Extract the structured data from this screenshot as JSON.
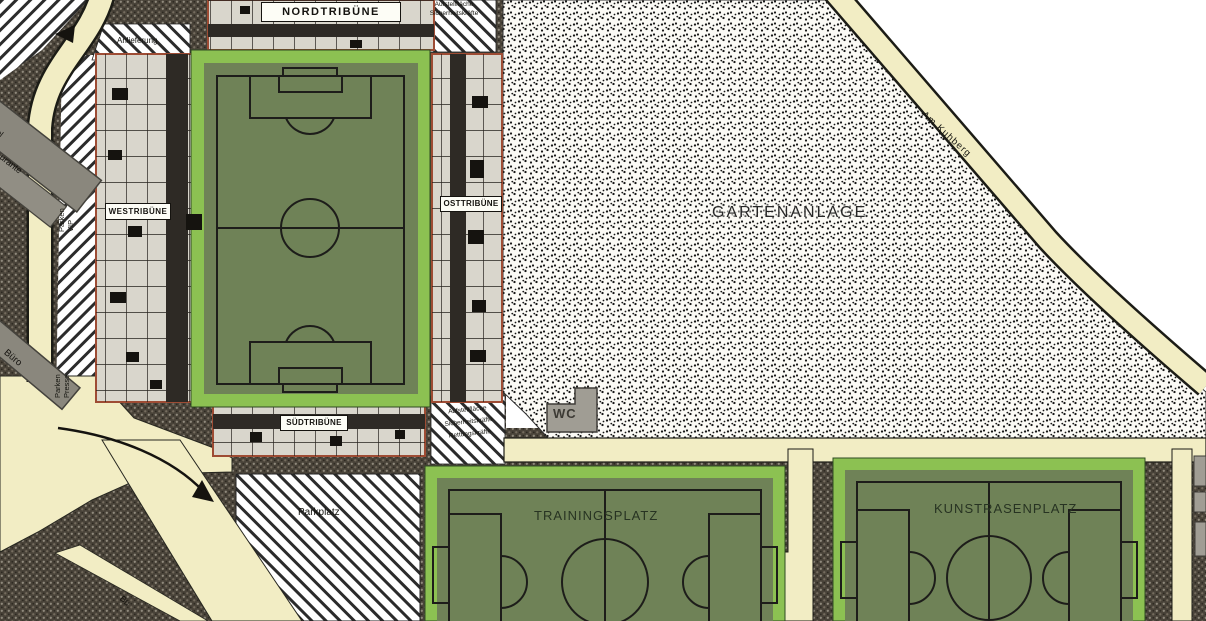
{
  "plan": {
    "stadium": {
      "north_stand_label": "NORDTRIBÜNE",
      "west_stand_label": "WESTRIBÜNE",
      "east_stand_label": "OSTTRIBÜNE",
      "south_stand_label": "SÜDTRIBÜNE"
    },
    "fields": {
      "training_pitch_label": "TRAININGSPLATZ",
      "artificial_turf_label": "KUNSTRASENPLATZ"
    },
    "areas": {
      "garden_label": "GARTENANLAGE",
      "parking_label": "Parkplatz",
      "delivery_label": "Anlieferung",
      "parken_vip": {
        "line1": "Parken",
        "line2": "VIP"
      },
      "parken_presse": {
        "line1": "Parken",
        "line2": "Presse"
      },
      "staging_north": {
        "line1": "Aufstellfläche",
        "line2": "Sicherheitskräfte"
      },
      "staging_south": {
        "line1": "Aufstellfläche",
        "line2": "Sicherheitskräfte",
        "line3": "Rettungskräfte"
      }
    },
    "buildings": {
      "wc_label": "WC",
      "office_label": "Büro",
      "building_fragment_small": "el",
      "building_fragment": "urante"
    },
    "streets": {
      "am_kuhberg_label": "Am Kuhberg",
      "street_fragment": "Bu"
    },
    "colors": {
      "road_yellow": "#f2edc4",
      "field_border_green": "#8cc152",
      "field_green": "#6f8257",
      "ground_dark": "#494339",
      "stand_gray": "#d9d6cc",
      "stand_outline_red": "#9e4c34"
    }
  }
}
